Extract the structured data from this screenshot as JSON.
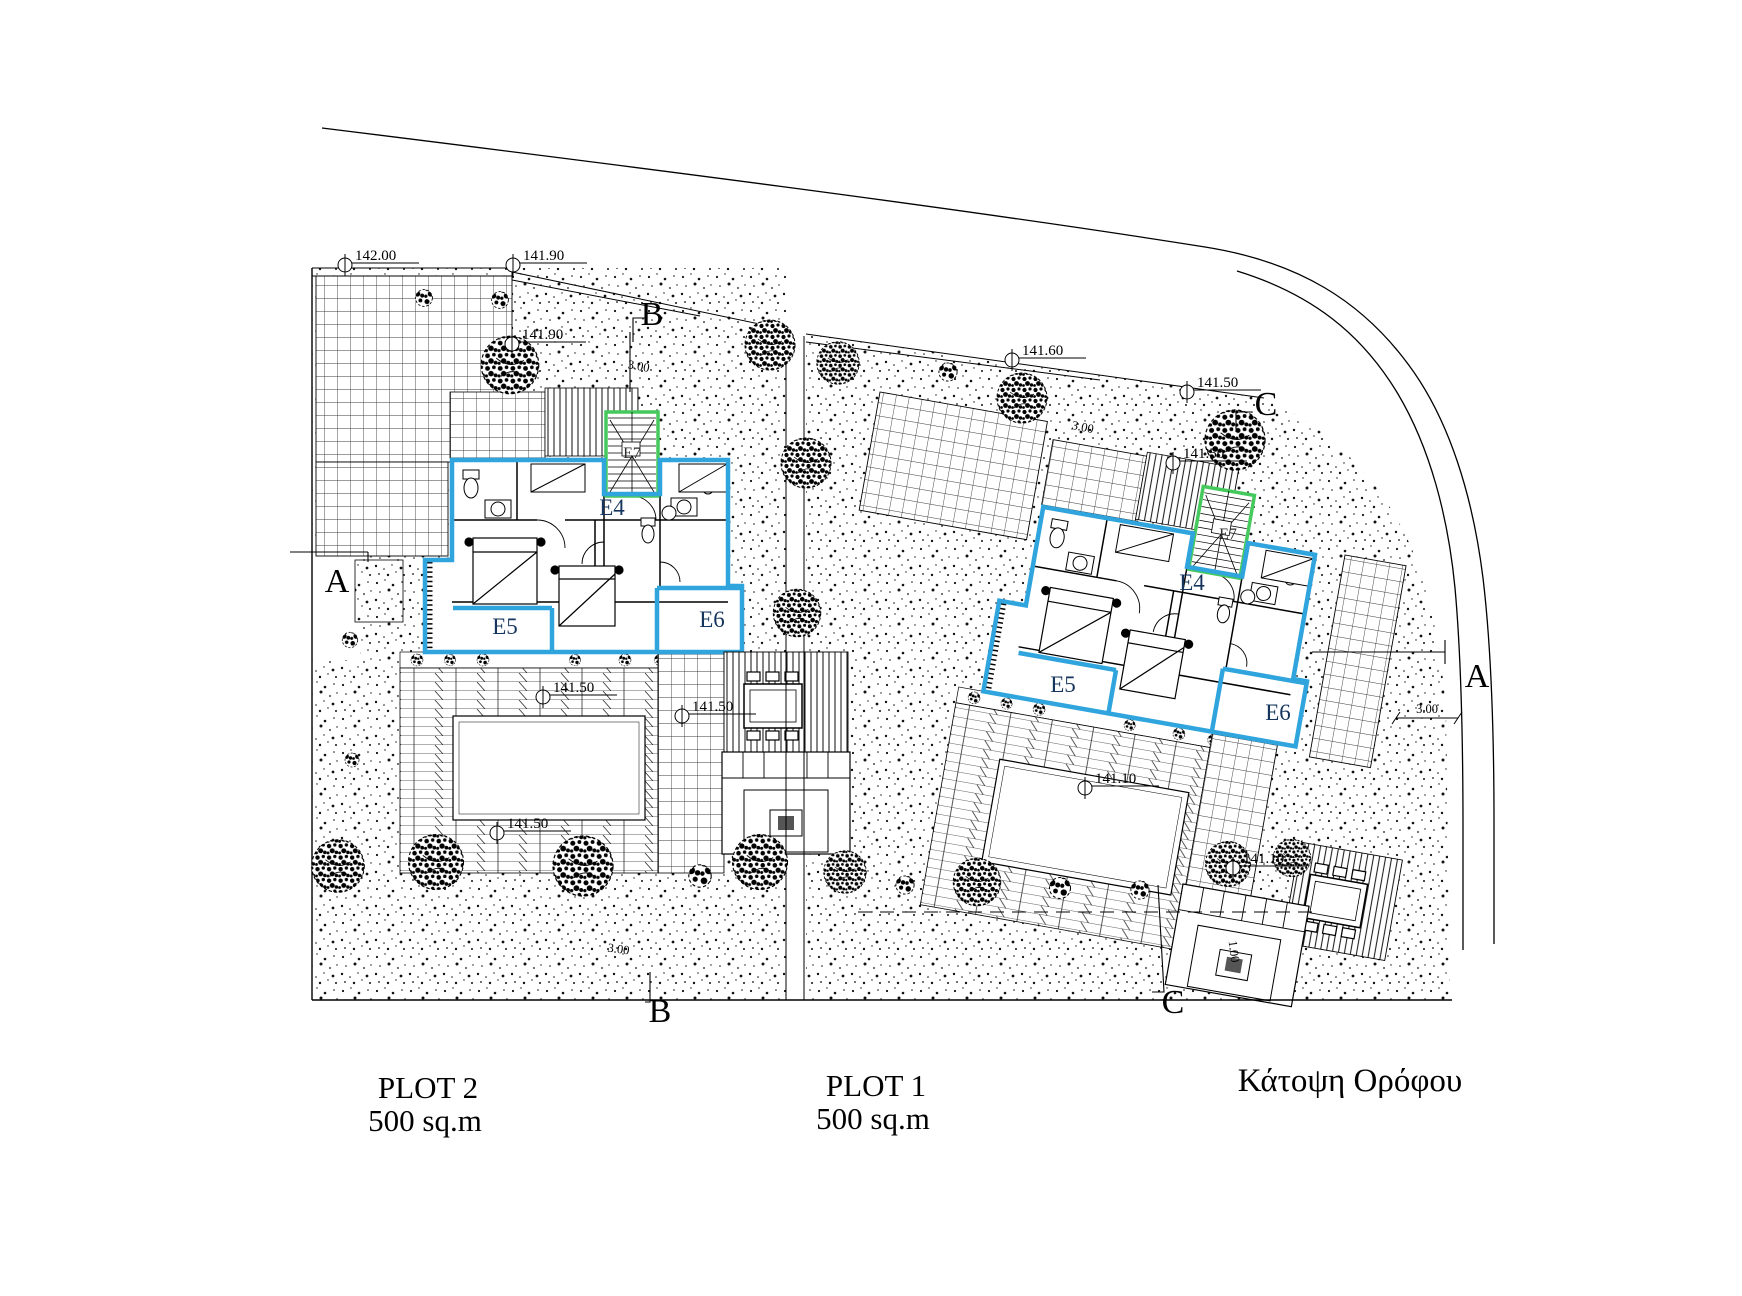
{
  "title": "Κάτοψη Ορόφου",
  "plots": [
    {
      "name": "PLOT 2",
      "area": "500 sq.m"
    },
    {
      "name": "PLOT 1",
      "area": "500 sq.m"
    }
  ],
  "unit_labels": {
    "e4": "E4",
    "e5": "E5",
    "e6": "E6",
    "e7": "E7"
  },
  "section_markers": {
    "a": "A",
    "b": "B",
    "c": "C"
  },
  "elevation_markers": [
    {
      "value": "142.00"
    },
    {
      "value": "141.90"
    },
    {
      "value": "141.90"
    },
    {
      "value": "141.60"
    },
    {
      "value": "141.50"
    },
    {
      "value": "141.50"
    },
    {
      "value": "141.50"
    },
    {
      "value": "141.50"
    },
    {
      "value": "141.50"
    },
    {
      "value": "141.10"
    },
    {
      "value": "141.10"
    }
  ],
  "dimensions": [
    {
      "value": "3.00"
    },
    {
      "value": "3.00"
    },
    {
      "value": "3.00"
    },
    {
      "value": "1.00"
    },
    {
      "value": "3.00"
    }
  ],
  "colors": {
    "unit_outline": "#2fa4dd",
    "stair_outline": "#45c95c",
    "unit_label": "#16355e"
  }
}
